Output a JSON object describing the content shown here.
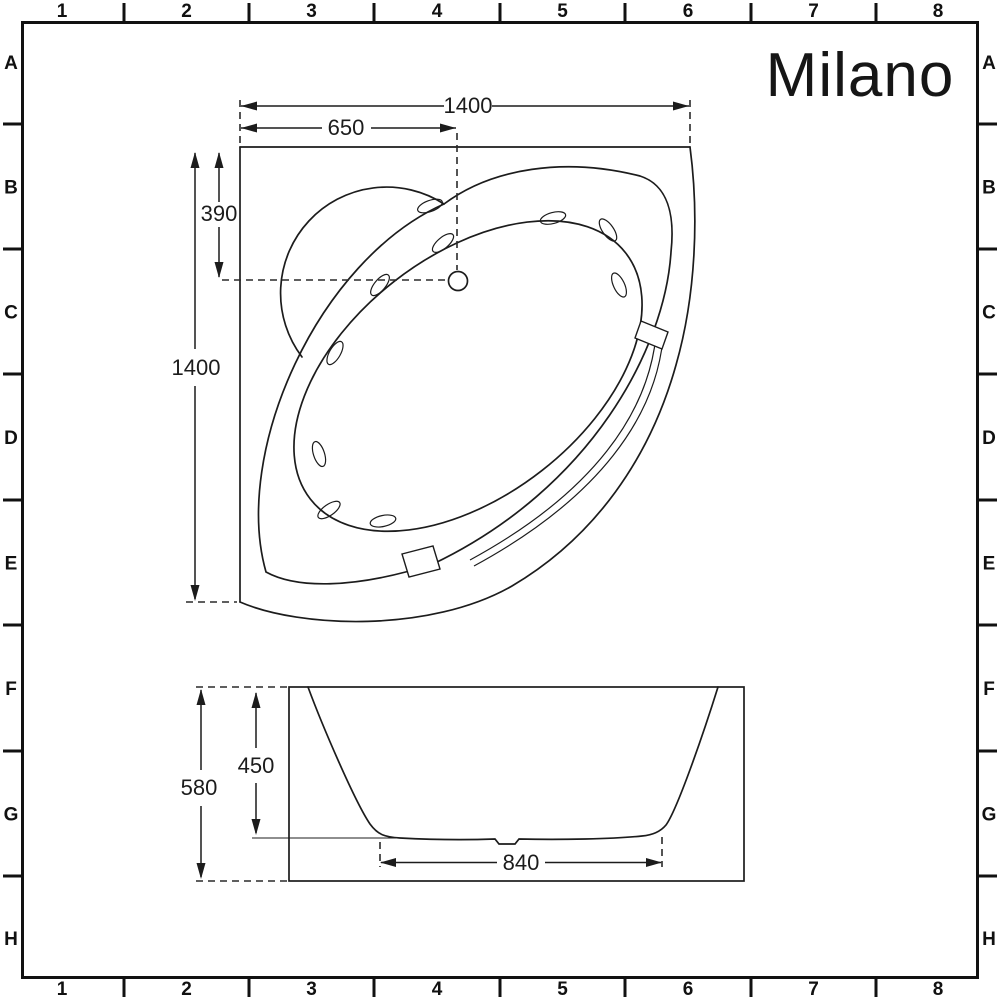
{
  "logo": {
    "text": "Milano"
  },
  "grid": {
    "column_labels": [
      "1",
      "2",
      "3",
      "4",
      "5",
      "6",
      "7",
      "8"
    ],
    "row_labels": [
      "A",
      "B",
      "C",
      "D",
      "E",
      "F",
      "G",
      "H"
    ]
  },
  "plan": {
    "overall_width": "1400",
    "waste_offset_x": "650",
    "waste_offset_y": "390",
    "overall_depth": "1400"
  },
  "elevation": {
    "overall_height": "580",
    "internal_depth": "450",
    "base_width": "840"
  },
  "colors": {
    "line": "#1c1c1c",
    "background": "#ffffff"
  }
}
